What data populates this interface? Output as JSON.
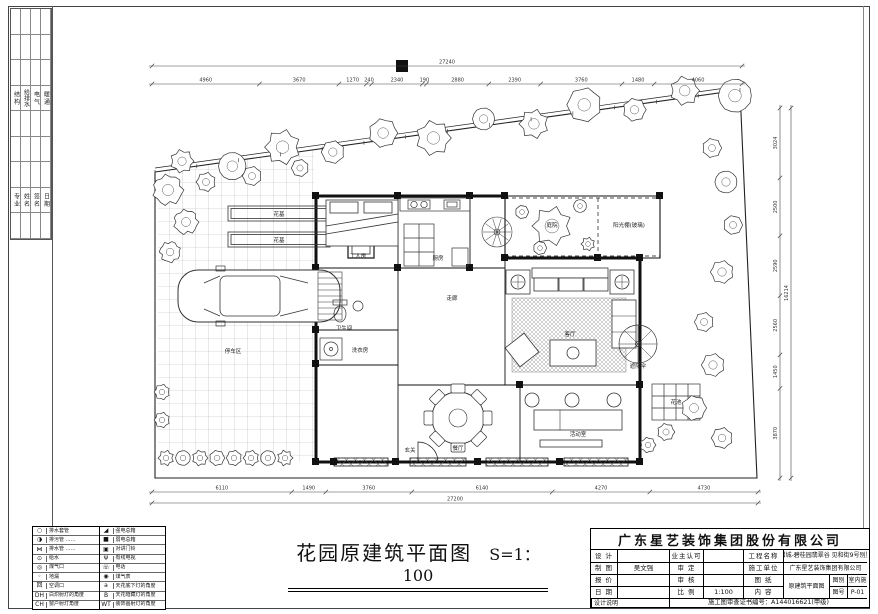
{
  "colors": {
    "paper": "#ffffff",
    "ink": "#1a1a1a",
    "grid": "#aaaaaa"
  },
  "sheet": {
    "plan_title": "花园原建筑平面图",
    "plan_scale": "S=1：100"
  },
  "signature_strip": {
    "group1": [
      "结 构",
      "给排水",
      "电 气",
      "暖 通"
    ],
    "group2": [
      "专 业",
      "姓 名",
      "签 名",
      "日 期"
    ]
  },
  "legend": {
    "left": [
      {
        "glyph": "○",
        "label": "排水套管"
      },
      {
        "glyph": "◑",
        "label": "排污管 ……"
      },
      {
        "glyph": "⋈",
        "label": "排水管 ……"
      },
      {
        "glyph": "⊙",
        "label": "给水"
      },
      {
        "glyph": "◎",
        "label": "煤气口"
      },
      {
        "glyph": "◦",
        "label": "地漏"
      },
      {
        "glyph": "回",
        "label": "空调口"
      },
      {
        "glyph": "DH",
        "label": "白炽射灯的角度"
      },
      {
        "glyph": "CH",
        "label": "窗户射灯角度"
      }
    ],
    "right": [
      {
        "glyph": "◢",
        "label": "强电总箱"
      },
      {
        "glyph": "■",
        "label": "弱电总箱"
      },
      {
        "glyph": "▣",
        "label": "对讲门铃"
      },
      {
        "glyph": "Ψ",
        "label": "有线电视"
      },
      {
        "glyph": "☏",
        "label": "电话"
      },
      {
        "glyph": "◉",
        "label": "煤气表"
      },
      {
        "glyph": "a",
        "label": "天花底下灯的角度"
      },
      {
        "glyph": "B",
        "label": "天花暗藏灯的角度"
      },
      {
        "glyph": "WT",
        "label": "装饰画射灯的角度"
      }
    ]
  },
  "dimensions": {
    "top": {
      "values": [
        4960,
        3670,
        1270,
        240,
        2340,
        190,
        2880,
        2390,
        3760,
        1480,
        4060
      ],
      "total": "27240"
    },
    "bottom": {
      "values": [
        6110,
        1490,
        3760,
        6140,
        4270,
        4730
      ],
      "total": "27200"
    },
    "right": {
      "values": [
        3024,
        2500,
        2590,
        2560,
        1450,
        3870
      ],
      "total": "16214"
    }
  },
  "room_labels": [
    {
      "t": "停车区",
      "x": 233,
      "y": 353
    },
    {
      "t": "花基",
      "x": 279,
      "y": 216
    },
    {
      "t": "花基",
      "x": 279,
      "y": 242
    },
    {
      "t": "工人房",
      "x": 358,
      "y": 258
    },
    {
      "t": "厨房",
      "x": 438,
      "y": 260
    },
    {
      "t": "卫生间",
      "x": 344,
      "y": 330
    },
    {
      "t": "洗衣房",
      "x": 360,
      "y": 352
    },
    {
      "t": "走廊",
      "x": 452,
      "y": 300
    },
    {
      "t": "客厅",
      "x": 570,
      "y": 336
    },
    {
      "t": "餐厅",
      "x": 458,
      "y": 450
    },
    {
      "t": "活动室",
      "x": 578,
      "y": 436
    },
    {
      "t": "玄关",
      "x": 410,
      "y": 452
    },
    {
      "t": "庭院",
      "x": 552,
      "y": 227
    },
    {
      "t": "阳光棚(玻璃)",
      "x": 629,
      "y": 227
    },
    {
      "t": "遮阳伞",
      "x": 638,
      "y": 368
    },
    {
      "t": "花池",
      "x": 676,
      "y": 404
    }
  ],
  "title_block": {
    "company": "广东星艺装饰集团股份有限公司",
    "rows": {
      "design_label": "设 计",
      "design_value": "",
      "owner_label": "业主认可",
      "owner_value": "",
      "project_label": "工程名称",
      "project_value": "增城-碧桂园翡翠谷 见和街9号别墅",
      "draft_label": "制 图",
      "draft_value": "吴文强",
      "approve_label": "审 定",
      "approve_value": "",
      "contractor_label": "施工单位",
      "contractor_value": "广东星艺装饰集团有限公司",
      "quote_label": "报 价",
      "quote_value": "",
      "check_label": "审 核",
      "check_value": "",
      "sheet_label": "图 纸",
      "sheet_content_value": "原建筑平面图",
      "category_label": "图别",
      "category_value": "室内施",
      "date_label": "日 期",
      "date_value": "",
      "ratio_label": "比 例",
      "ratio_value": "1:100",
      "content_label": "内 容",
      "number_label": "图号",
      "number_value": "P-01",
      "note_label": "设计说明",
      "cert_label": "施工图审查证书编号：",
      "cert_value": "A144016621(甲级)"
    }
  }
}
